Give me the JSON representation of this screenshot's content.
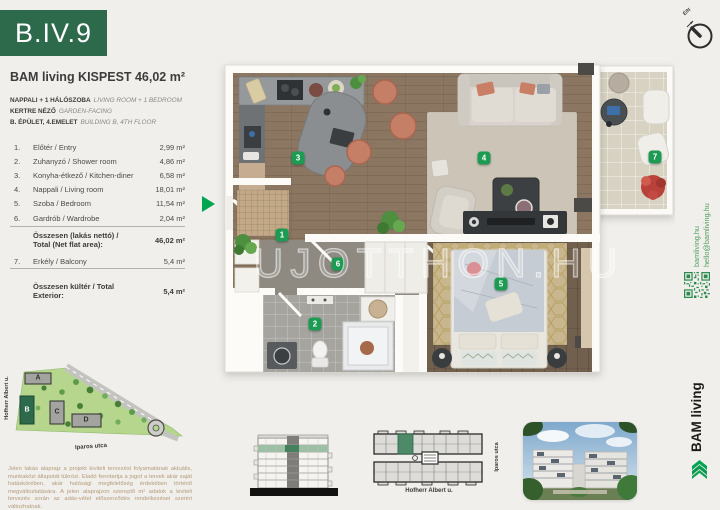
{
  "unit": {
    "code": "B.IV.9",
    "project": "BAM living KISPEST",
    "total_area": "46,02 m²",
    "features": [
      {
        "hu": "NAPPALI + 1 HÁLÓSZOBA",
        "en": "LIVING ROOM + 1 BEDROOM"
      },
      {
        "hu": "KERTRE NÉZŐ",
        "en": "GARDEN-FACING"
      },
      {
        "hu": "B. ÉPÜLET, 4.EMELET",
        "en": "BUILDING B, 4TH FLOOR"
      }
    ],
    "rooms": [
      {
        "no": "1.",
        "name": "Előtér / Entry",
        "area": "2,99 m²"
      },
      {
        "no": "2.",
        "name": "Zuhanyzó / Shower room",
        "area": "4,86 m²"
      },
      {
        "no": "3.",
        "name": "Konyha-étkező / Kitchen-diner",
        "area": "6,58 m²"
      },
      {
        "no": "4.",
        "name": "Nappali / Living room",
        "area": "18,01 m²"
      },
      {
        "no": "5.",
        "name": "Szoba / Bedroom",
        "area": "11,54 m²"
      },
      {
        "no": "6.",
        "name": "Gardrób / Wardrobe",
        "area": "2,04 m²"
      }
    ],
    "net_total": {
      "label": "Összesen (lakás nettó) / Total (Net flat area):",
      "value": "46,02 m²"
    },
    "exterior_rooms": [
      {
        "no": "7.",
        "name": "Erkély / Balcony",
        "area": "5,4 m²"
      }
    ],
    "exterior_total": {
      "label": "Összesen kültér / Total Exterior:",
      "value": "5,4 m²"
    }
  },
  "floorplan": {
    "watermark": "UJOTTHON.HU",
    "badges": [
      "1",
      "2",
      "3",
      "4",
      "5",
      "6",
      "7"
    ]
  },
  "sitemap": {
    "buildings": [
      "A",
      "B",
      "C",
      "D"
    ],
    "street_left": "Hofherr Albert u.",
    "street_bottom": "Iparos utca"
  },
  "keyplan": {
    "street_bottom": "Hofherr Albert u.",
    "street_right": "Iparos utca"
  },
  "disclaimer": "Jelen lakás alaprajz a projekt kiviteli tervezési folyamatának aktuális, munkaközi állapotát tükrözi. Eladó fenntartja a jogot a tervek akár saját hatáskörében, akár hatósági megfelelőség érdekében történő megváltoztatására. A jelen alaprajzon szereplő m² adatok a kiviteli tervezés során az adás-vétel előszerződés rendelkezései szerint változhatnak.",
  "contact": {
    "web": "bamliving.hu",
    "email": "hello@bamliving.hu",
    "brand": "BAM living"
  },
  "compass": {
    "label": "É/N"
  },
  "colors": {
    "brand_green": "#2d6a4c",
    "badge_green": "#1d9b52",
    "accent_green": "#00a551"
  }
}
